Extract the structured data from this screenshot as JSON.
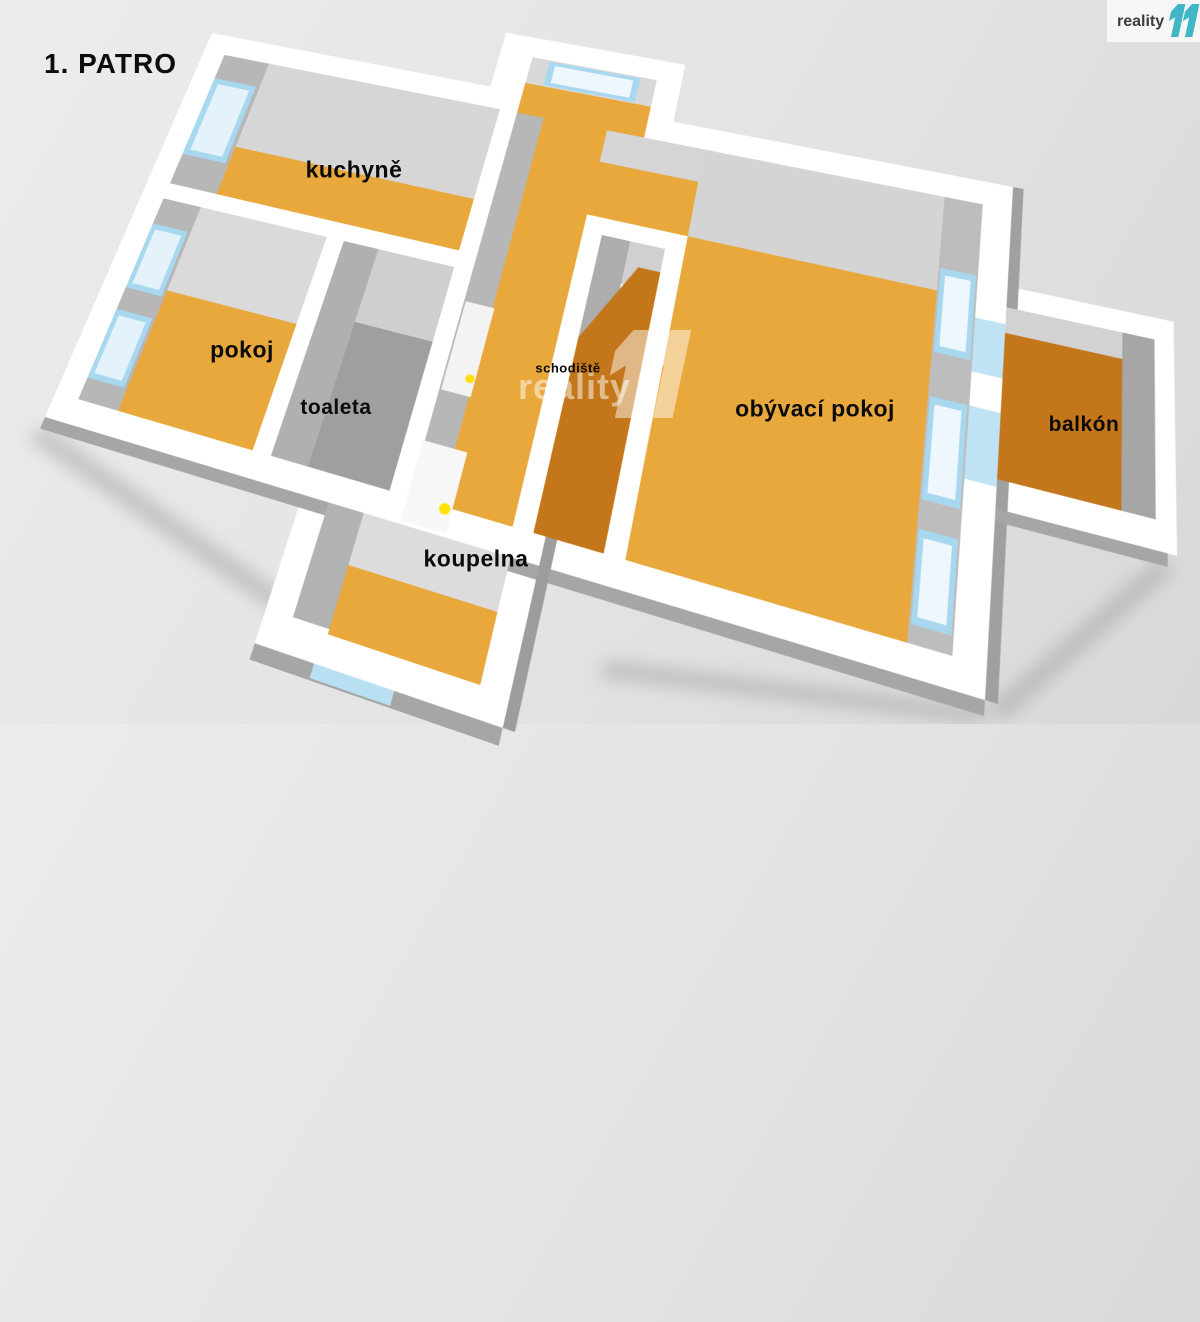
{
  "title": "1. PATRO",
  "logo": {
    "brand": "reality",
    "brand_number": "11"
  },
  "watermark": {
    "text": "reality",
    "number": "11"
  },
  "rooms": {
    "kuchyne": {
      "label": "kuchyně"
    },
    "pokoj": {
      "label": "pokoj"
    },
    "toaleta": {
      "label": "toaleta"
    },
    "schodiste": {
      "label": "schodiště"
    },
    "obyvaci_pokoj": {
      "label": "obývací pokoj"
    },
    "balkon": {
      "label": "balkón"
    },
    "koupelna": {
      "label": "koupelna"
    }
  },
  "colors": {
    "floor_orange": "#e8a83c",
    "floor_dark_orange": "#c4761a",
    "wall_white": "#ffffff",
    "wall_gray_light": "#d6d6d6",
    "wall_gray_mid": "#b7b7b7",
    "toilet_floor_gray": "#9f9f9f",
    "window_blue": "#a8d8ef",
    "door_handle_yellow": "#ffe200",
    "logo_teal": "#41b7c6",
    "background": "#e3e3e3"
  }
}
